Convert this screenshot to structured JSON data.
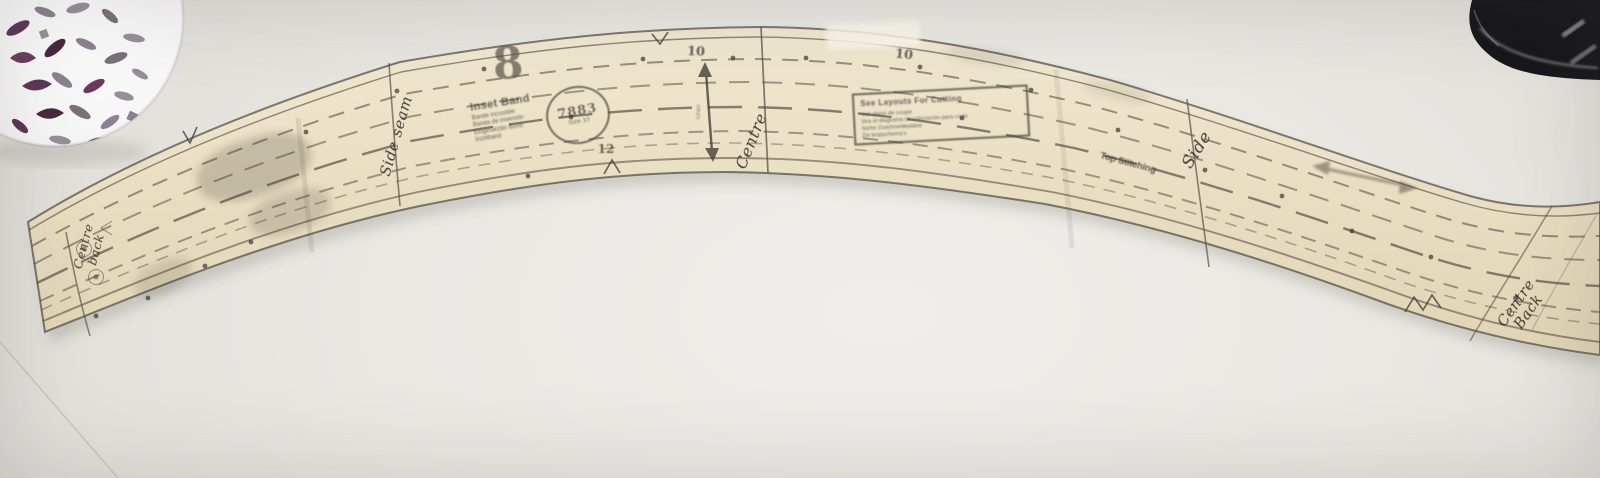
{
  "colors": {
    "table": "#e9e7e2",
    "tissue": "#ece1c4",
    "ink": "#3f3b34",
    "appliance_black": "#17171b",
    "cutout_purple": "#5e3556"
  },
  "pattern": {
    "big_size_number": "8",
    "top_number_1": "10",
    "top_number_2": "10",
    "bottom_number": "12",
    "stamp": {
      "number": "7883",
      "size": "Size 10"
    },
    "name_block": {
      "title": "Inset Band",
      "line1": "Bande incrustée",
      "line2": "Banda de inserción",
      "line3": "Eingesetzter Bund",
      "line4": "Inzetband"
    },
    "layout_box": {
      "title": "See Layouts For Cutting",
      "line1": "Voir plans de coupe",
      "line2": "Vea el diagrama de colocación para corte",
      "line3": "Siehe Zuschneidepläne",
      "line4": "Zie knipschema's"
    },
    "top_stitching_label": "Top Stitching",
    "grain_label": "Grain",
    "handwriting": {
      "side_seam": "Side seam",
      "centre": "Centre",
      "side": "Side",
      "centre_back_left_line1": "Centre",
      "centre_back_left_line2": "back",
      "centre_back_right_line1": "Centre",
      "centre_back_right_line2": "Back"
    }
  }
}
